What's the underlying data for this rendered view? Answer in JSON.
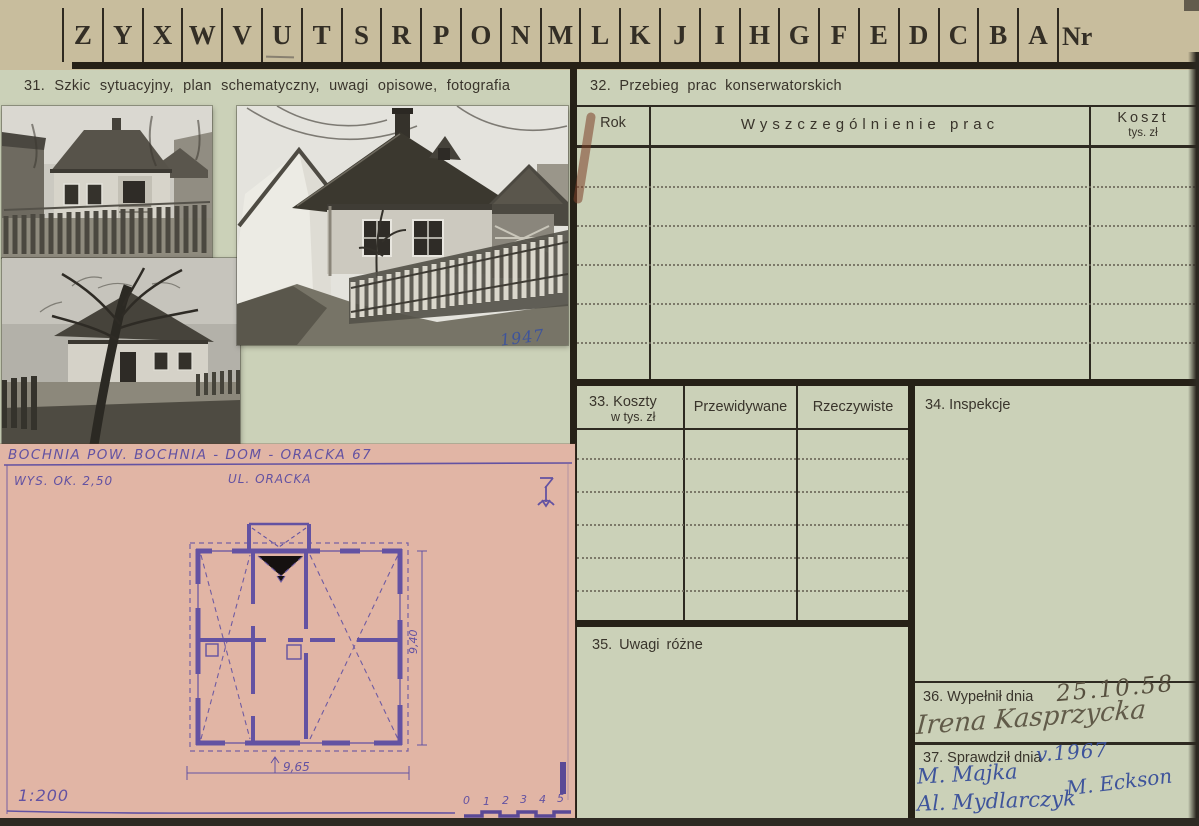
{
  "colors": {
    "card_green": "#cbd1b8",
    "top_tan": "#c8bd9d",
    "rule_dark": "#262117",
    "plan_pink": "#e1b5a5",
    "ink_purple": "#6352a2",
    "ink_blue": "#3e549b",
    "pencil_gray": "#564f3e"
  },
  "index_strip": {
    "letters": [
      "Z",
      "Y",
      "X",
      "W",
      "V",
      "U",
      "T",
      "S",
      "R",
      "P",
      "O",
      "N",
      "M",
      "L",
      "K",
      "J",
      "I",
      "H",
      "G",
      "F",
      "E",
      "D",
      "C",
      "B",
      "A"
    ],
    "nr_label": "Nr"
  },
  "section31": {
    "title": "31. Szkic sytuacyjny, plan schematyczny, uwagi opisowe, fotografia",
    "photo_note": "1947"
  },
  "plan_sheet": {
    "title": "BOCHNIA POW. BOCHNIA - DOM - ORACKA 67",
    "height_note": "WYS. OK. 2,50",
    "street_label": "UL. ORACKA",
    "dim_width": "9,65",
    "dim_height": "9,40",
    "scale_label": "1:200",
    "scale_numbers": [
      "0",
      "1",
      "2",
      "3",
      "4",
      "5"
    ]
  },
  "section32": {
    "title": "32. Przebieg prac konserwatorskich",
    "col_rok": "Rok",
    "col_prace": "Wyszczególnienie prac",
    "col_koszt": "Koszt",
    "col_koszt_sub": "tys. zł"
  },
  "section33": {
    "title_line1": "33. Koszty",
    "title_line2": "w tys. zł",
    "col_przewidywane": "Przewidywane",
    "col_rzeczywiste": "Rzeczywiste"
  },
  "section34": {
    "title": "34. Inspekcje"
  },
  "section35": {
    "title": "35. Uwagi różne"
  },
  "section36": {
    "label": "36. Wypełnił dnia",
    "date": "25.10.58",
    "signature": "Irena Kasprzycka"
  },
  "section37": {
    "label": "37. Sprawdził dnia",
    "date": "v.1967",
    "signatures": [
      "M. Majka",
      "Al. Mydlarczyk",
      "M. Eckson"
    ]
  }
}
